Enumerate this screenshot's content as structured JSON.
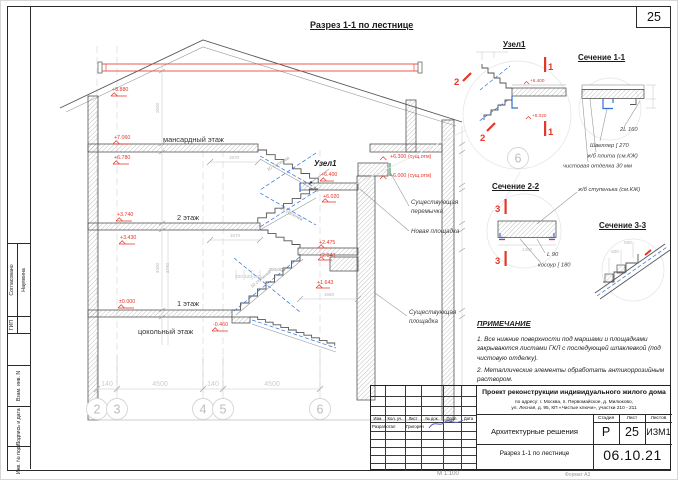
{
  "page": {
    "number": "25",
    "scale_note": "М 1:100",
    "format_note": "Формат А3"
  },
  "title": "Разрез 1-1 по лестнице",
  "section": {
    "floors": {
      "attic": "мансардный этаж",
      "second": "2 этаж",
      "first": "1 этаж",
      "basement": "цокольный этаж"
    },
    "node_label": "Узел1",
    "flight_label": "10 ступеней",
    "elev": {
      "e8880": "+8.880",
      "e7060": "+7.060",
      "e6780": "+6.780",
      "e3740": "+3.740",
      "e3430": "+3.430",
      "e0": "±0.000",
      "em046": "-0.460",
      "e64": "+6.400",
      "e602": "+6.020",
      "e2475": "+2.475",
      "e204": "+2.040",
      "e1643": "+1.643",
      "e63": "+6.300 (сущ.отм)",
      "e60": "+6.000 (сущ.отм)"
    },
    "ann": {
      "lintel1": "Существующая",
      "lintel2": "перемычка",
      "new_landing": "Новая площадка",
      "exist1": "Существующая",
      "exist2": "площадка"
    },
    "dims": {
      "v2600": "2600",
      "v3400": "3400",
      "v3740": "3740",
      "h1970": "1970",
      "h1870": "1870",
      "t420": "420  420  420",
      "t300": "300х300",
      "h1660": "1660"
    },
    "axes": {
      "b2": "2",
      "b3": "3",
      "b4": "4",
      "b5": "5",
      "b6": "6",
      "d140a": "140",
      "d4500a": "4500",
      "d140b": "140",
      "d4500b": "4500"
    }
  },
  "details": {
    "uzel1": {
      "heading": "Узел1",
      "m1": "1",
      "m2": "2",
      "etop": "+6.400",
      "ebot": "+6.020",
      "bubble": "6"
    },
    "sec11": {
      "heading": "Сечение 1-1",
      "n1": "2L 160",
      "n2": "Швеллер [ 270",
      "n3": "ж/б плита (см.КЖ)",
      "n4": "чистовая отделка 30 мм"
    },
    "sec22": {
      "heading": "Сечение 2-2",
      "mark": "3",
      "dim": "1400",
      "n1": "L 90",
      "n2": "косоур [ 180",
      "slab": "ж/б ступенька (см.КЖ)"
    },
    "sec33": {
      "heading": "Сечение 3-3",
      "d1": "600",
      "d2": "600"
    }
  },
  "notes": {
    "heading": "ПРИМЕЧАНИЕ",
    "i1": "1.     Все нижние поверхности под маршами и площадками закрываются листами ГКЛ с последующей шпаклевкой (под чистовую отделку).",
    "i2": "2.     Металлические элементы обработать антикоррозийным раствором."
  },
  "titleblock": {
    "project": "Проект реконструкции индивидуального жилого дома",
    "address1": "по адресу:  г. Москва, п. Первомайское, д. Милюково,",
    "address2": "ул. Лесная, д. 95, КП «Чистые ключи», участки 210 - 211",
    "doc_type": "Архитектурные решения",
    "sheet_title": "Разрез 1-1 по лестнице",
    "stage_label": "Стадия",
    "list_label": "Лист",
    "lists_label": "Листов",
    "stage": "Р",
    "list": "25",
    "lists": "ИЗМ1",
    "date": "06.10.21",
    "c1": "Изм.",
    "c2": "Кол. уч.",
    "c3": "Лист",
    "c4": "№ док.",
    "c5": "Подп.",
    "c6": "Дата",
    "dev_label": "Разработал",
    "dev_name": "Григорян"
  },
  "stamp": {
    "agreed": "Согласовано",
    "gip": "ГИП",
    "name": "Наумкина",
    "vzam": "Взам. инв. N",
    "sign": "Подпись и дата",
    "inv": "Инв. № подл."
  }
}
